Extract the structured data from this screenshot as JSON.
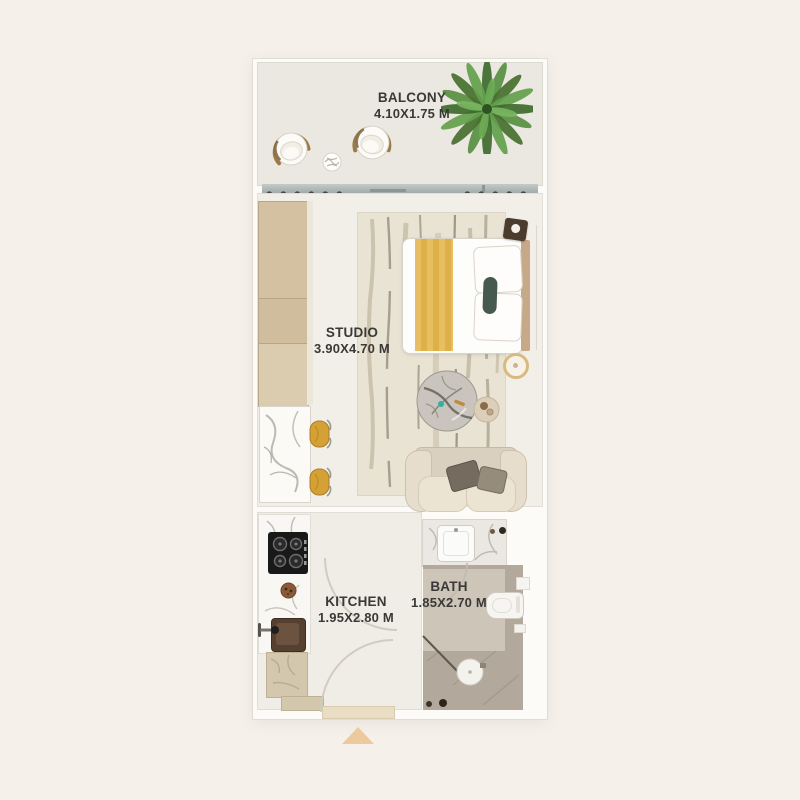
{
  "page": {
    "background": "#f5f1ea"
  },
  "plan": {
    "type": "studio-apartment-floor-plan",
    "rooms": [
      {
        "id": "balcony",
        "label": "BALCONY",
        "dims": "4.10X1.75 M"
      },
      {
        "id": "studio",
        "label": "STUDIO",
        "dims": "3.90X4.70 M"
      },
      {
        "id": "kitchen",
        "label": "KITCHEN",
        "dims": "1.95X2.80 M"
      },
      {
        "id": "bath",
        "label": "BATH",
        "dims": "1.85X2.70 M"
      }
    ],
    "entrance_marker": {
      "shape": "triangle-up",
      "color": "#ecca9e"
    },
    "palette": {
      "page_bg": "#f5f1ea",
      "plan_bg": "#fcfbf8",
      "balcony_floor": "#ebe8e1",
      "studio_floor": "#f2efe9",
      "kitchen_floor": "#f0ede6",
      "bath_floor": "#b2a99c",
      "bath_floor_light": "#cdc5b8",
      "wardrobe_wood": "#d3c1a2",
      "bed_accent_gold": "#e4b95a",
      "stool_gold": "#d5a136",
      "sofa_beige": "#e6ddcc",
      "plant_green": "#4a7c36",
      "pillow_green": "#475a4f",
      "slider_gray": "#aab3b1",
      "label_text": "#3a3937"
    },
    "furniture": [
      "potted-palm",
      "armchair",
      "armchair",
      "decor-ball",
      "curtains",
      "sliding-door",
      "wardrobe",
      "breakfast-counter",
      "bar-stool",
      "bar-stool",
      "area-rug",
      "double-bed",
      "pillows",
      "nightstand",
      "floor-lamp",
      "coffee-table",
      "side-table",
      "sofa",
      "cooktop",
      "prep-bowl",
      "kitchen-sink",
      "base-cabinet",
      "bathroom-vanity",
      "washbasin",
      "toilet",
      "shower",
      "entrance-door"
    ]
  }
}
